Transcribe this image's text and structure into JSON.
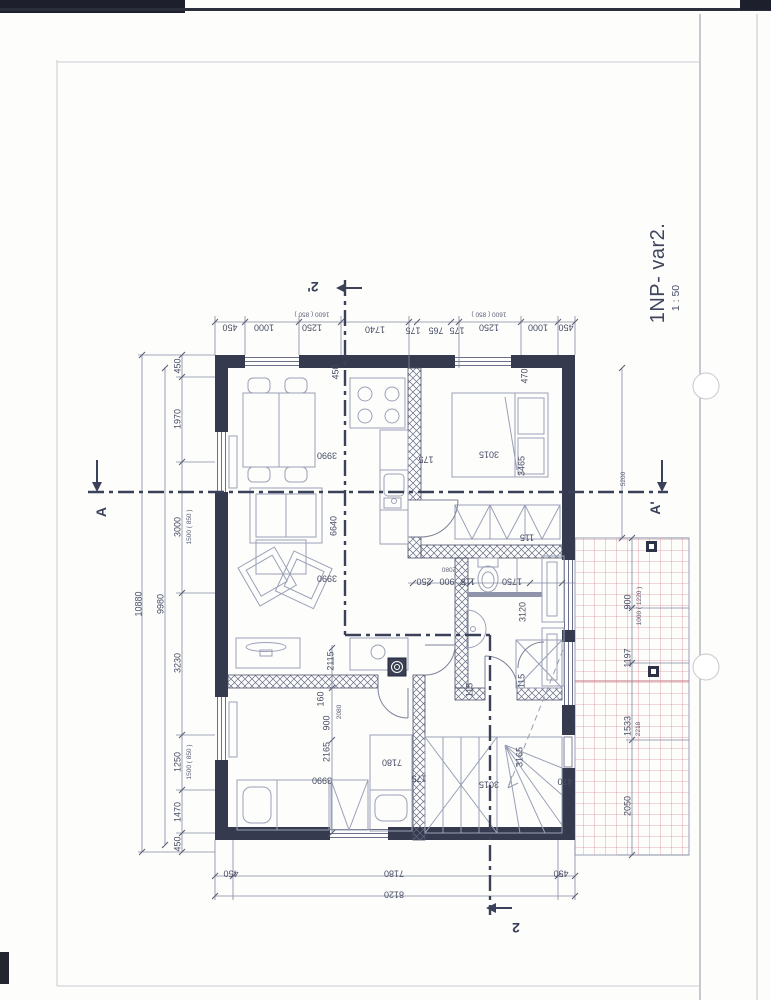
{
  "title": {
    "label": "1NP- var2.",
    "scale": "1 : 50"
  },
  "colors": {
    "ink": "#353a4e",
    "furniture": "#9aa1b6",
    "dim": "#8489a0",
    "text": "#474c63",
    "terrace_grid": "#d98f96",
    "section": "#3c415a"
  },
  "section_markers": [
    {
      "t": "A",
      "x": 101,
      "y": 512,
      "r": -90,
      "s": "lg",
      "n": "section-marker-a"
    },
    {
      "t": "A'",
      "x": 655,
      "y": 508,
      "r": -90,
      "s": "lg",
      "n": "section-marker-a-prime"
    },
    {
      "t": "2'",
      "x": 313,
      "y": 287,
      "r": 180,
      "s": "lg",
      "n": "section-marker-2-prime"
    },
    {
      "t": "2",
      "x": 516,
      "y": 928,
      "r": 180,
      "s": "lg",
      "n": "section-marker-2"
    }
  ],
  "dim_labels": [
    {
      "t": "450",
      "x": 230,
      "y": 327,
      "r": 180
    },
    {
      "t": "1000",
      "x": 264,
      "y": 327,
      "r": 180
    },
    {
      "t": "1250",
      "x": 312,
      "y": 327,
      "r": 180
    },
    {
      "t": "1600 ( 850 )",
      "x": 312,
      "y": 313,
      "r": 180,
      "s": "sm"
    },
    {
      "t": "1740",
      "x": 375,
      "y": 329,
      "r": 180
    },
    {
      "t": "175",
      "x": 413,
      "y": 330,
      "r": 180
    },
    {
      "t": "765",
      "x": 436,
      "y": 330,
      "r": 180
    },
    {
      "t": "175",
      "x": 457,
      "y": 330,
      "r": 180
    },
    {
      "t": "1250",
      "x": 489,
      "y": 327,
      "r": 180
    },
    {
      "t": "1600 ( 850 )",
      "x": 489,
      "y": 313,
      "r": 180,
      "s": "sm"
    },
    {
      "t": "1000",
      "x": 538,
      "y": 327,
      "r": 180
    },
    {
      "t": "450",
      "x": 566,
      "y": 327,
      "r": 180
    },
    {
      "t": "450",
      "x": 178,
      "y": 366,
      "r": -90
    },
    {
      "t": "1970",
      "x": 178,
      "y": 419,
      "r": -90
    },
    {
      "t": "3000",
      "x": 178,
      "y": 527,
      "r": -90
    },
    {
      "t": "1500 ( 850 )",
      "x": 190,
      "y": 527,
      "r": -90,
      "s": "sm"
    },
    {
      "t": "3230",
      "x": 178,
      "y": 663,
      "r": -90
    },
    {
      "t": "1250",
      "x": 178,
      "y": 762,
      "r": -90
    },
    {
      "t": "1500 ( 850 )",
      "x": 190,
      "y": 762,
      "r": -90,
      "s": "sm"
    },
    {
      "t": "1470",
      "x": 178,
      "y": 812,
      "r": -90
    },
    {
      "t": "450",
      "x": 178,
      "y": 844,
      "r": -90
    },
    {
      "t": "9980",
      "x": 161,
      "y": 604,
      "r": -90
    },
    {
      "t": "10880",
      "x": 139,
      "y": 604,
      "r": -90
    },
    {
      "t": "450",
      "x": 231,
      "y": 873,
      "r": 180
    },
    {
      "t": "7180",
      "x": 394,
      "y": 873,
      "r": 180
    },
    {
      "t": "450",
      "x": 561,
      "y": 873,
      "r": 180
    },
    {
      "t": "8120",
      "x": 394,
      "y": 894,
      "r": 180
    },
    {
      "t": "5200",
      "x": 624,
      "y": 479,
      "r": -90,
      "s": "sm"
    },
    {
      "t": "900",
      "x": 628,
      "y": 602,
      "r": -90
    },
    {
      "t": "1000 ( 1220 )",
      "x": 640,
      "y": 606,
      "r": -90,
      "s": "sm"
    },
    {
      "t": "1197",
      "x": 628,
      "y": 658,
      "r": -90
    },
    {
      "t": "1533",
      "x": 628,
      "y": 726,
      "r": -90
    },
    {
      "t": "2218",
      "x": 639,
      "y": 729,
      "r": -90,
      "s": "sm"
    },
    {
      "t": "2050",
      "x": 628,
      "y": 806,
      "r": -90
    },
    {
      "t": "450",
      "x": 336,
      "y": 372,
      "r": -90
    },
    {
      "t": "3990",
      "x": 327,
      "y": 455,
      "r": 180
    },
    {
      "t": "175",
      "x": 426,
      "y": 459,
      "r": 180
    },
    {
      "t": "3015",
      "x": 489,
      "y": 454,
      "r": 180
    },
    {
      "t": "3465",
      "x": 522,
      "y": 466,
      "r": -90
    },
    {
      "t": "470",
      "x": 525,
      "y": 376,
      "r": -90
    },
    {
      "t": "6640",
      "x": 334,
      "y": 526,
      "r": -90
    },
    {
      "t": "3990",
      "x": 327,
      "y": 578,
      "r": 180
    },
    {
      "t": "250",
      "x": 424,
      "y": 581,
      "r": 180
    },
    {
      "t": "900",
      "x": 447,
      "y": 581,
      "r": 180
    },
    {
      "t": "115",
      "x": 468,
      "y": 581,
      "r": 180
    },
    {
      "t": "2080",
      "x": 449,
      "y": 568,
      "r": 180,
      "s": "sm"
    },
    {
      "t": "1750",
      "x": 512,
      "y": 581,
      "r": 180
    },
    {
      "t": "3120",
      "x": 523,
      "y": 612,
      "r": -90
    },
    {
      "t": "115",
      "x": 527,
      "y": 537,
      "r": 180
    },
    {
      "t": "115",
      "x": 522,
      "y": 681,
      "r": -90
    },
    {
      "t": "2115",
      "x": 331,
      "y": 661,
      "r": -90
    },
    {
      "t": "160",
      "x": 321,
      "y": 699,
      "r": -90
    },
    {
      "t": "900",
      "x": 327,
      "y": 723,
      "r": -90
    },
    {
      "t": "2080",
      "x": 340,
      "y": 712,
      "r": -90,
      "s": "sm"
    },
    {
      "t": "2165",
      "x": 327,
      "y": 752,
      "r": -90
    },
    {
      "t": "3990",
      "x": 322,
      "y": 780,
      "r": 180
    },
    {
      "t": "7180",
      "x": 392,
      "y": 762,
      "r": 180
    },
    {
      "t": "175",
      "x": 419,
      "y": 778,
      "r": 180
    },
    {
      "t": "3015",
      "x": 489,
      "y": 784,
      "r": 180
    },
    {
      "t": "3165",
      "x": 520,
      "y": 757,
      "r": -90
    },
    {
      "t": "470",
      "x": 565,
      "y": 781,
      "r": 180
    },
    {
      "t": "115",
      "x": 470,
      "y": 690,
      "r": -90
    }
  ]
}
